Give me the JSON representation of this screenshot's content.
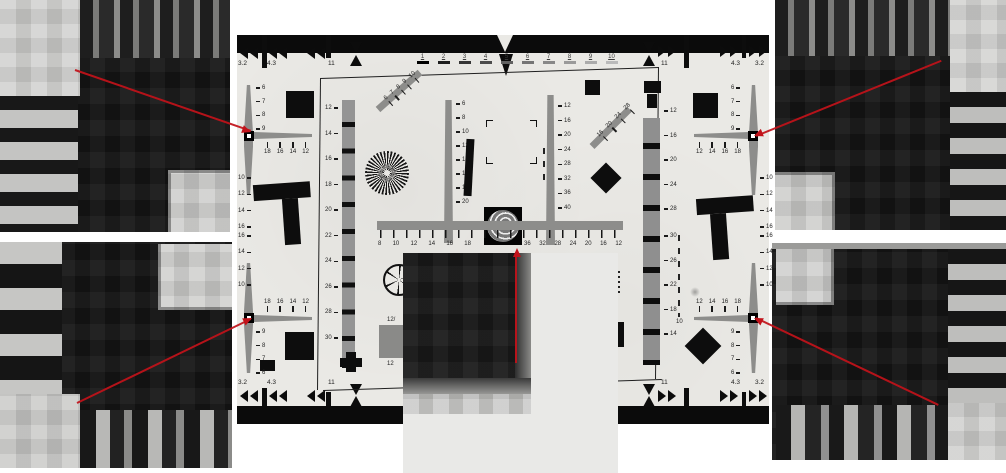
{
  "scene": {
    "description": "ISO 12233 resolution test chart photograph with four pixel-level corner crops and one magnified center crop linked by red callout arrows",
    "background": "#ffffff",
    "arrow_color": "#c2121a",
    "chart_bg": "#eae9e5"
  },
  "chart": {
    "aspect_top_left": [
      "3.2",
      "4.3",
      "11"
    ],
    "aspect_top_right": [
      "11",
      "4.3",
      "3.2"
    ],
    "aspect_bottom_left": [
      "3.2",
      "4.3",
      "11"
    ],
    "aspect_bottom_right": [
      "11",
      "4.3",
      "3.2"
    ],
    "top_scale": [
      "1",
      "2",
      "3",
      "4",
      "5",
      "6",
      "7",
      "8",
      "9",
      "10"
    ],
    "crosshairs": {
      "tl": {
        "wedge": [
          "6",
          "7",
          "8",
          "9"
        ],
        "across": [
          "18",
          "16",
          "14",
          "12"
        ],
        "ext": [
          "10",
          "12",
          "14",
          "16"
        ]
      },
      "tr": {
        "wedge": [
          "6",
          "7",
          "8",
          "9"
        ],
        "across": [
          "12",
          "14",
          "16",
          "18"
        ],
        "ext": [
          "10",
          "12",
          "14",
          "16"
        ]
      },
      "bl": {
        "wedge": [
          "9",
          "8",
          "7",
          "6"
        ],
        "across": [
          "18",
          "16",
          "14",
          "12"
        ],
        "ext": [
          "16",
          "14",
          "12",
          "10"
        ]
      },
      "br": {
        "wedge": [
          "9",
          "8",
          "7",
          "6"
        ],
        "across": [
          "12",
          "14",
          "16",
          "18"
        ],
        "ext": [
          "16",
          "14",
          "12",
          "10"
        ]
      }
    },
    "left_strip_labels": [
      "12",
      "14",
      "16",
      "18",
      "20",
      "22",
      "24",
      "26",
      "28",
      "30"
    ],
    "right_strip_labels_upper": [
      "12",
      "16",
      "20",
      "24",
      "28"
    ],
    "right_strip_labels_lower": [
      "30",
      "26",
      "22",
      "18",
      "14"
    ],
    "center_left_wedge_labels": [
      "6",
      "8",
      "10",
      "12",
      "14",
      "16",
      "18",
      "20"
    ],
    "center_right_wedge_labels": [
      "12",
      "16",
      "20",
      "24",
      "28",
      "32",
      "36",
      "40"
    ],
    "diag_left_labels": [
      "6",
      "7",
      "8",
      "9",
      "10"
    ],
    "diag_right_labels": [
      "16",
      "20",
      "24",
      "28"
    ],
    "ruler_left_labels": [
      "8",
      "10",
      "12",
      "14",
      "16",
      "18"
    ],
    "ruler_right_labels": [
      "36",
      "32",
      "28",
      "24",
      "20",
      "16",
      "12"
    ],
    "misc": {
      "gray_square_top": "12/",
      "gray_square_bottom": "12",
      "dashed_line_label": "10"
    }
  }
}
